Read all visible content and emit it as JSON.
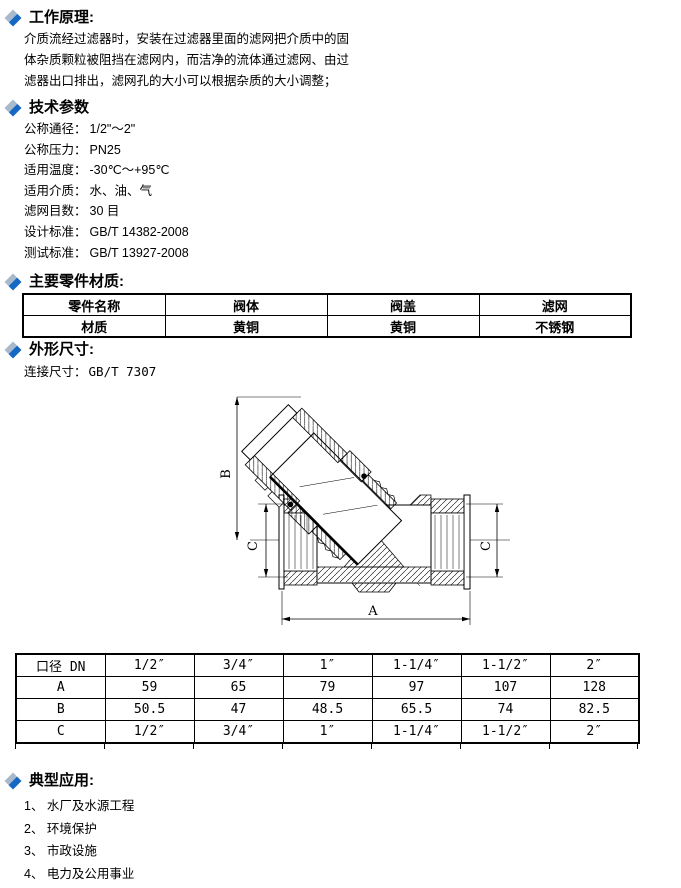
{
  "sections": {
    "working_principle": {
      "heading": "工作原理:",
      "lines": [
        "介质流经过滤器时，安装在过滤器里面的滤网把介质中的固",
        "体杂质颗粒被阻挡在滤网内，而洁净的流体通过滤网、由过",
        "滤器出口排出，滤网孔的大小可以根据杂质的大小调整；"
      ]
    },
    "tech_params": {
      "heading": "技术参数",
      "items": [
        {
          "label": "公称通径：",
          "value": "1/2\"～2\""
        },
        {
          "label": "公称压力：",
          "value": "PN25"
        },
        {
          "label": "适用温度：",
          "value": "-30℃～+95℃"
        },
        {
          "label": "适用介质：",
          "value": "水、油、气"
        },
        {
          "label": "滤网目数：",
          "value": "30 目"
        },
        {
          "label": "设计标准：",
          "value": "GB/T 14382-2008"
        },
        {
          "label": "测试标准：",
          "value": "GB/T 13927-2008"
        }
      ]
    },
    "materials": {
      "heading": "主要零件材质:",
      "table": {
        "rows": [
          [
            "零件名称",
            "阀体",
            "阀盖",
            "滤网"
          ],
          [
            "材质",
            "黄铜",
            "黄铜",
            "不锈钢"
          ]
        ]
      }
    },
    "dimensions": {
      "heading": "外形尺寸:",
      "connection_note_label": "连接尺寸：",
      "connection_note_value": "GB/T 7307",
      "drawing_labels": {
        "a": "A",
        "b": "B",
        "c_left": "C",
        "c_right": "C"
      },
      "table": {
        "rows": [
          [
            "口径 DN",
            "1/2″",
            "3/4″",
            "1″",
            "1-1/4″",
            "1-1/2″",
            "2″"
          ],
          [
            "A",
            "59",
            "65",
            "79",
            "97",
            "107",
            "128"
          ],
          [
            "B",
            "50.5",
            "47",
            "48.5",
            "65.5",
            "74",
            "82.5"
          ],
          [
            "C",
            "1/2″",
            "3/4″",
            "1″",
            "1-1/4″",
            "1-1/2″",
            "2″"
          ]
        ]
      }
    },
    "applications": {
      "heading": "典型应用:",
      "items": [
        "1、 水厂及水源工程",
        "2、 环境保护",
        "3、 市政设施",
        "4、 电力及公用事业",
        "5、 建筑行业"
      ]
    }
  },
  "colors": {
    "diamond_dark": "#1568c4",
    "diamond_light": "#a7b9cb"
  }
}
